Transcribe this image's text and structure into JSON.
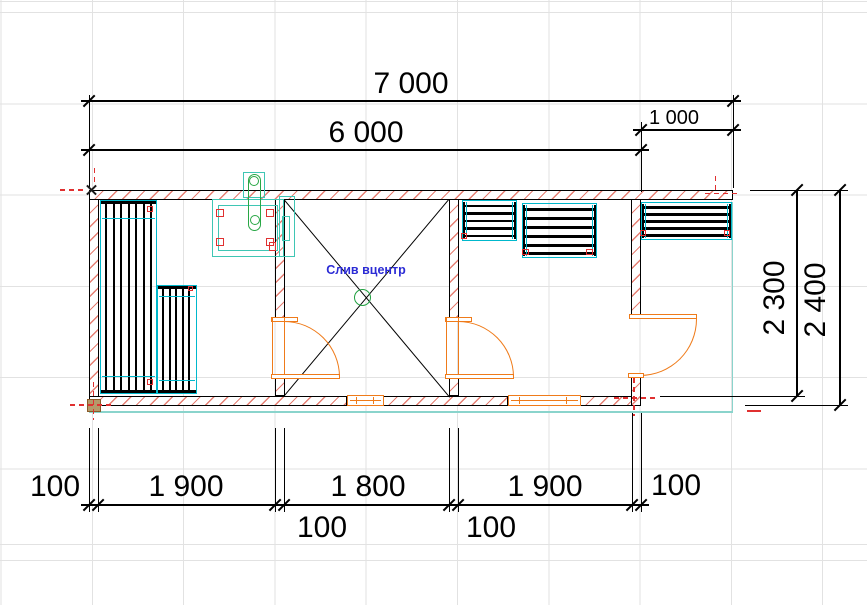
{
  "dims": {
    "top_total": "7 000",
    "top_main": "6 000",
    "top_porch": "1 000",
    "right_inner": "2 300",
    "right_outer": "2 400",
    "bottom_left_wall": "100",
    "bottom_room1": "1 900",
    "bottom_room2": "1 800",
    "bottom_room3": "1 900",
    "bottom_right_wall": "100",
    "bottom_partition1": "100",
    "bottom_partition2": "100"
  },
  "notes": {
    "drain": "Слив вцентр"
  },
  "colors": {
    "wall_hatch": "#e05f50",
    "joinery_orange": "#ef7b1a",
    "bench_cyan": "#00b8cc",
    "fixture_teal": "#3fc6b4",
    "chimney_green": "#28a745",
    "drain_green": "#20a040",
    "note_blue": "#2b2bd5",
    "marker_red": "#e03030",
    "post_brown": "#b49a6a",
    "porch_teal": "#8ad4cc",
    "grid_gray": "#e2e2e2"
  }
}
